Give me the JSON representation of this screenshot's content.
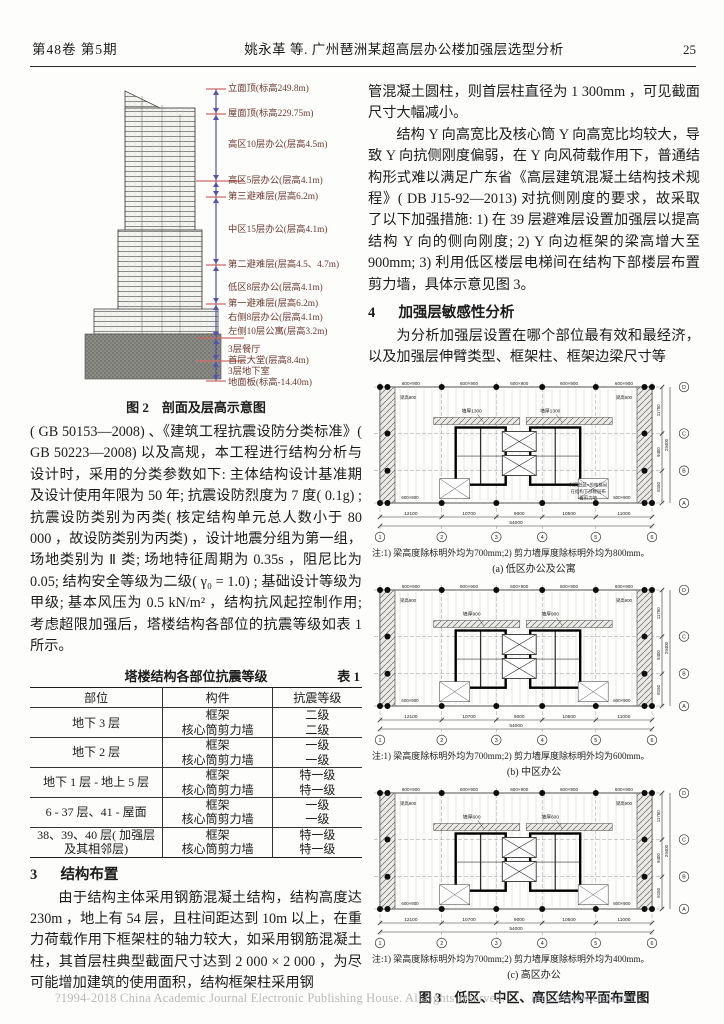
{
  "header": {
    "issue": "第48卷 第5期",
    "running_title": "姚永革 等. 广州琶洲某超高层办公楼加强层选型分析",
    "page_number": "25"
  },
  "left_column": {
    "figure2": {
      "labels": [
        "立面顶(标高249.8m)",
        "屋面顶(标高229.75m)",
        "高区10层办公(层高4.5m)",
        "高区5层办公(层高4.1m)",
        "第三避难层(层高6.2m)",
        "中区15层办公(层高4.1m)",
        "第二避难层(层高4.5、4.7m)",
        "低区8层办公(层高4.1m)",
        "第一避难层(层高6.2m)",
        "右侧8层办公(层高4.1m)",
        "左侧10层公寓(层高3.2m)",
        "3层餐厅",
        "首层大堂(层高8.4m)",
        "3层地下室",
        "地面板(标高-14.40m)"
      ],
      "caption": "图 2　剖面及层高示意图"
    },
    "para1": "( GB 50153—2008) 、《建筑工程抗震设防分类标准》( GB 50223—2008) 以及高规，本工程进行结构分析与设计时，采用的分类参数如下: 主体结构设计基准期及设计使用年限为 50 年; 抗震设防烈度为 7 度( 0.1g) ; 抗震设防类别为丙类( 核定结构单元总人数小于 80 000 ，故设防类别为丙类) ，设计地震分组为第一组，场地类别为 Ⅱ 类; 场地特征周期为 0.35s ，阻尼比为 0.05; 结构安全等级为二级( γ₀ = 1.0) ; 基础设计等级为甲级; 基本风压为 0.5 kN/m² ，结构抗风起控制作用; 考虑超限加强后，塔楼结构各部位的抗震等级如表 1 所示。",
    "table1": {
      "title": "塔楼结构各部位抗震等级",
      "tag": "表 1",
      "headers": [
        "部位",
        "构件",
        "抗震等级"
      ],
      "groups": [
        {
          "part": "地下 3 层",
          "rows": [
            [
              "框架",
              "二级"
            ],
            [
              "核心筒剪力墙",
              "二级"
            ]
          ]
        },
        {
          "part": "地下 2 层",
          "rows": [
            [
              "框架",
              "一级"
            ],
            [
              "核心筒剪力墙",
              "一级"
            ]
          ]
        },
        {
          "part": "地下 1 层 - 地上 5 层",
          "rows": [
            [
              "框架",
              "特一级"
            ],
            [
              "核心筒剪力墙",
              "特一级"
            ]
          ]
        },
        {
          "part": "6 - 37 层、41 - 屋面",
          "rows": [
            [
              "框架",
              "一级"
            ],
            [
              "核心筒剪力墙",
              "一级"
            ]
          ]
        },
        {
          "part": "38、39、40 层( 加强层及其相邻层)",
          "rows": [
            [
              "框架",
              "特一级"
            ],
            [
              "核心筒剪力墙",
              "特一级"
            ]
          ]
        }
      ]
    },
    "section3": {
      "num": "3",
      "title": "结构布置"
    },
    "para2": "由于结构主体采用钢筋混凝土结构，结构高度达 230m ，地上有 54 层，且柱间距达到 10m 以上，在重力荷载作用下框架柱的轴力较大，如采用钢筋混凝土柱，其首层柱典型截面尺寸达到 2 000 × 2 000 ，为尽可能增加建筑的使用面积，结构框架柱采用钢"
  },
  "right_column": {
    "para1": "管混凝土圆柱，则首层柱直径为 1 300mm ，可见截面尺寸大幅减小。",
    "para2": "结构 Y 向高宽比及核心筒 Y 向高宽比均较大，导致 Y 向抗侧刚度偏弱，在 Y 向风荷载作用下，普通结构形式难以满足广东省《高层建筑混凝土结构技术规程》( DB J15-92—2013) 对抗侧刚度的要求，故采取了以下加强措施: 1) 在 39 层避难层设置加强层以提高结构 Y 向的侧向刚度; 2) Y 向边框架的梁高增大至 900mm; 3) 利用低区楼层电梯间在结构下部楼层布置剪力墙，具体示意见图 3。",
    "section4": {
      "num": "4",
      "title": "加强层敏感性分析"
    },
    "para3": "为分析加强层设置在哪个部位最有效和最经济，以及加强层伸臂类型、框架柱、框架边梁尺寸等",
    "figure3": {
      "plans": [
        {
          "beam_label": "600×900",
          "corner_label": "梁高900",
          "wall_label": "墙厚1300",
          "annotation": [
            "利用低区×的电梯间",
            "在结构下部楼层布",
            "置剪力墙"
          ],
          "dims": [
            "12100",
            "10700",
            "9000",
            "10500",
            "11000"
          ],
          "total": "54000",
          "right_dims": [
            "11750",
            "9400",
            "8150"
          ],
          "right_total": "29400",
          "axes_bottom": [
            "1",
            "2",
            "3",
            "4",
            "5",
            "6"
          ],
          "axes_right": [
            "D",
            "C",
            "B",
            "A"
          ],
          "note": "注:1) 梁高度除标明外均为700mm;2) 剪力墙厚度除标明外均为800mm。",
          "caption": "(a) 低区办公及公寓"
        },
        {
          "beam_label": "600×900",
          "corner_label": "梁高900",
          "wall_label": "墙厚900",
          "annotation": null,
          "dims": [
            "12100",
            "10700",
            "9000",
            "10500",
            "11000"
          ],
          "total": "54000",
          "right_dims": [
            "11750",
            "9400",
            "8150"
          ],
          "right_total": "29400",
          "axes_bottom": [
            "1",
            "2",
            "3",
            "4",
            "5",
            "6"
          ],
          "axes_right": [
            "D",
            "C",
            "B",
            "A"
          ],
          "note": "注:1) 梁高度除标明外均为700mm;2) 剪力墙厚度除标明外均为600mm。",
          "caption": "(b) 中区办公"
        },
        {
          "beam_label": "600×900",
          "corner_label": "梁高900",
          "wall_label": "墙厚600",
          "annotation": null,
          "dims": [
            "12100",
            "10700",
            "9000",
            "10500",
            "11000"
          ],
          "total": "54000",
          "right_dims": [
            "11750",
            "9400",
            "8150"
          ],
          "right_total": "29400",
          "axes_bottom": [
            "1",
            "2",
            "3",
            "4",
            "5",
            "6"
          ],
          "axes_right": [
            "D",
            "C",
            "B",
            "A"
          ],
          "note": "注:1) 梁高度除标明外均为700mm;2) 剪力墙厚度除标明外均为400mm。",
          "caption": "(c) 高区办公"
        }
      ],
      "caption": "图 3　低区、中区、高区结构平面布置图"
    }
  },
  "footer": {
    "text": "?1994-2018 China Academic Journal Electronic Publishing House. All rights reserved.",
    "url": "http://www.cnki.net"
  }
}
